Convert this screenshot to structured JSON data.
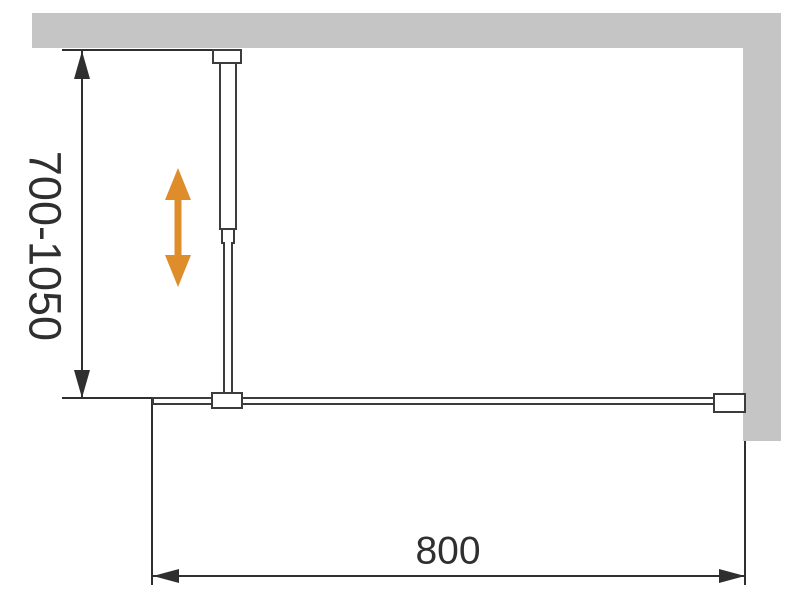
{
  "diagram": {
    "dimensions": {
      "height_range": "700-1050",
      "width": "800"
    },
    "colors": {
      "wall": "#c5c5c5",
      "line": "#3c3c3c",
      "dimension": "#2f2f2f",
      "accent": "#df8c2b",
      "background": "#ffffff"
    },
    "icons": {
      "adjust_arrow": "vertical-double-arrow",
      "height_dim_arrows": "up-down-dimension-arrows",
      "width_dim_arrows": "left-right-dimension-arrows"
    }
  }
}
